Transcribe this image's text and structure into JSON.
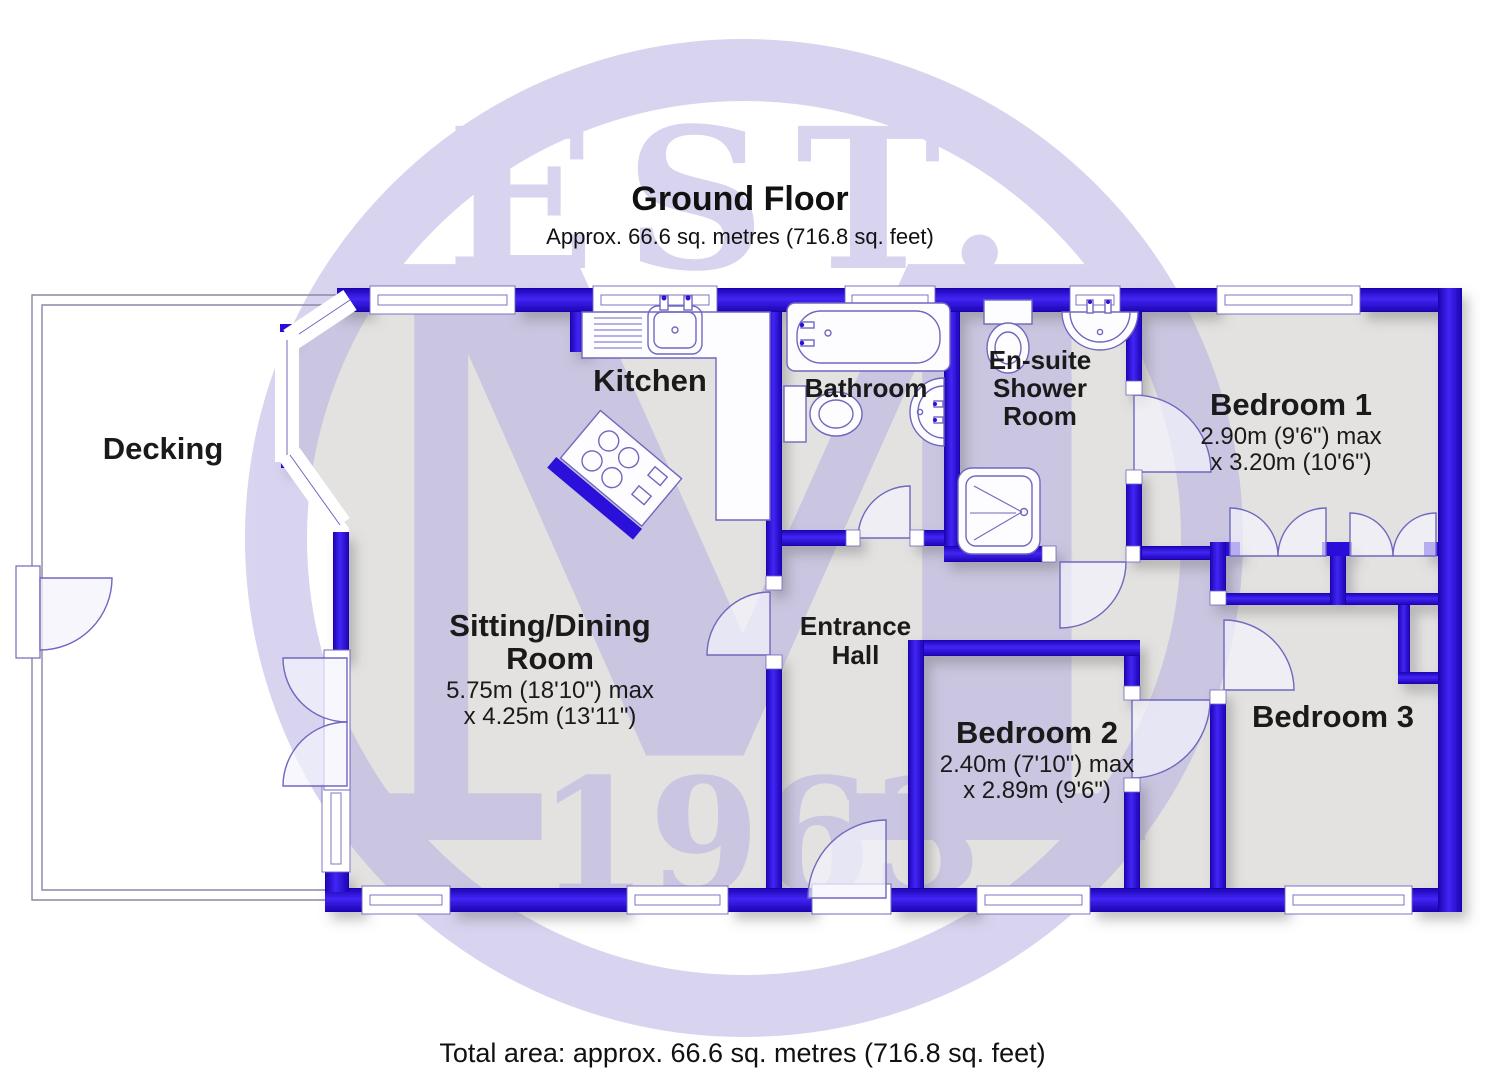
{
  "header": {
    "title": "Ground Floor",
    "subtitle": "Approx. 66.6 sq. metres (716.8 sq. feet)"
  },
  "footer": {
    "total_area": "Total area: approx. 66.6 sq. metres (716.8 sq. feet)"
  },
  "watermark": {
    "top": "EST.",
    "monogram": "M",
    "bottom": "1963"
  },
  "rooms": {
    "decking": {
      "name": "Decking"
    },
    "kitchen": {
      "name": "Kitchen"
    },
    "bathroom": {
      "name": "Bathroom"
    },
    "ensuite": {
      "line1": "En-suite",
      "line2": "Shower",
      "line3": "Room"
    },
    "bedroom1": {
      "name": "Bedroom 1",
      "dim1": "2.90m (9'6\") max",
      "dim2": "x 3.20m (10'6\")"
    },
    "sitting": {
      "line1": "Sitting/Dining",
      "line2": "Room",
      "dim1": "5.75m (18'10\") max",
      "dim2": "x 4.25m (13'11\")"
    },
    "hall": {
      "line1": "Entrance",
      "line2": "Hall"
    },
    "bedroom2": {
      "name": "Bedroom 2",
      "dim1": "2.40m (7'10\") max",
      "dim2": "x 2.89m (9'6\")"
    },
    "bedroom3": {
      "name": "Bedroom 3"
    }
  },
  "colors": {
    "wall_blue": "#2a10d8",
    "floor_grey": "#e3e2e0",
    "watermark_lavender": "#b3a9e0",
    "fixture_outline": "#6f68bf"
  }
}
